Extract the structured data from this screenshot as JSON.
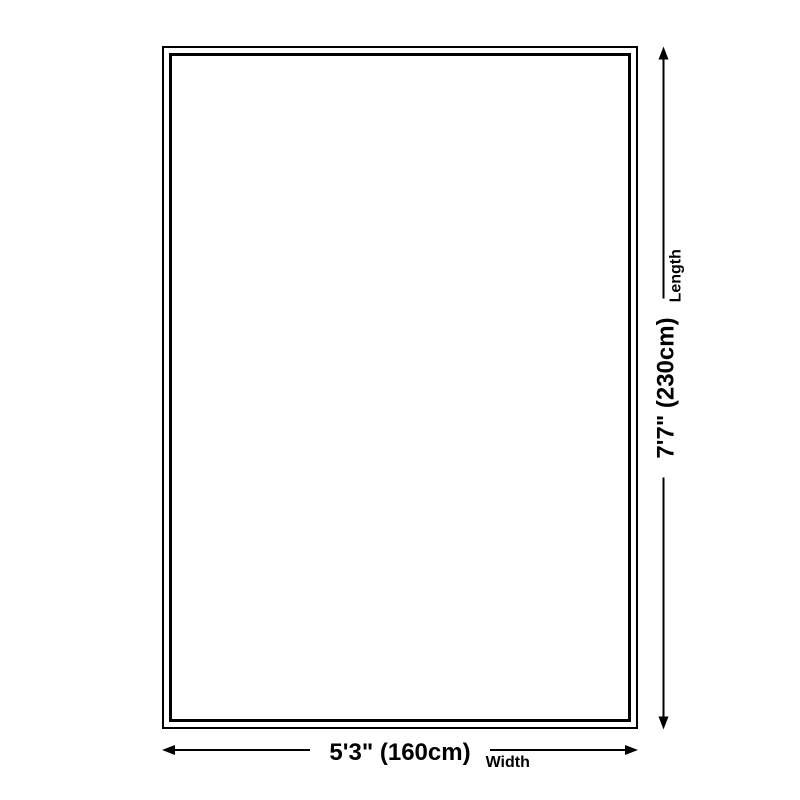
{
  "dimensions": {
    "width": {
      "value": "5'3\" (160cm)",
      "label": "Width"
    },
    "length": {
      "value": "7'7\" (230cm)",
      "label": "Length"
    }
  },
  "colors": {
    "line": "#000000",
    "background": "#ffffff"
  }
}
